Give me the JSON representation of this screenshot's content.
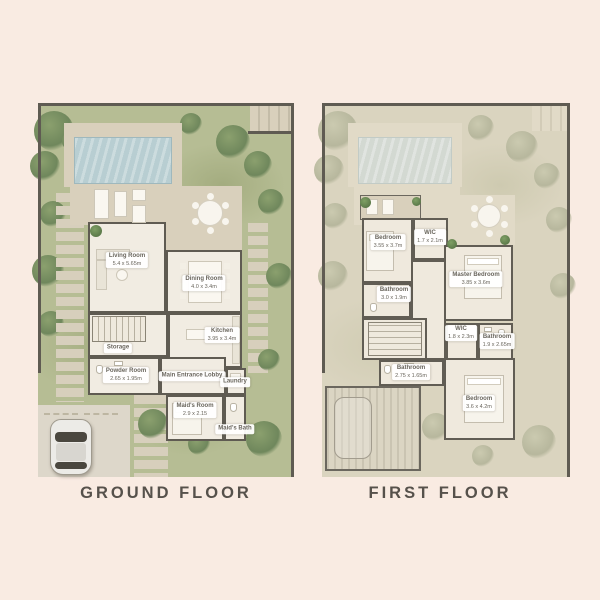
{
  "ground_floor": {
    "title": "GROUND FLOOR",
    "rooms": [
      {
        "name": "Living Room",
        "dims": "5.4 x 5.65m"
      },
      {
        "name": "Dining Room",
        "dims": "4.0 x 3.4m"
      },
      {
        "name": "Kitchen",
        "dims": "3.95 x 3.4m"
      },
      {
        "name": "Storage",
        "dims": ""
      },
      {
        "name": "Powder Room",
        "dims": "2.65 x 1.95m"
      },
      {
        "name": "Main Entrance Lobby",
        "dims": ""
      },
      {
        "name": "Laundry",
        "dims": ""
      },
      {
        "name": "Maid's Room",
        "dims": "2.9 x 2.15"
      },
      {
        "name": "Maid's Bath",
        "dims": ""
      }
    ]
  },
  "first_floor": {
    "title": "FIRST FLOOR",
    "rooms": [
      {
        "name": "Bedroom",
        "dims": "3.55 x 3.7m"
      },
      {
        "name": "WIC",
        "dims": "1.7 x 2.1m"
      },
      {
        "name": "Master Bedroom",
        "dims": "3.85 x 3.6m"
      },
      {
        "name": "Bathroom",
        "dims": "3.0 x 1.9m"
      },
      {
        "name": "WIC",
        "dims": "1.8 x 2.3m"
      },
      {
        "name": "Bathroom",
        "dims": "1.9 x 2.65m"
      },
      {
        "name": "Bathroom",
        "dims": "2.75 x 1.65m"
      },
      {
        "name": "Bedroom",
        "dims": "3.6 x 4.2m"
      }
    ]
  },
  "colors": {
    "background": "#f9ebe2",
    "garden": "#b6bd94",
    "garden_faded": "#dad4bf",
    "deck": "#d9d0bc",
    "interior": "#f1ece2",
    "wall": "#5f5b52",
    "pool": "#b8ced2",
    "title_text": "#56514b"
  }
}
